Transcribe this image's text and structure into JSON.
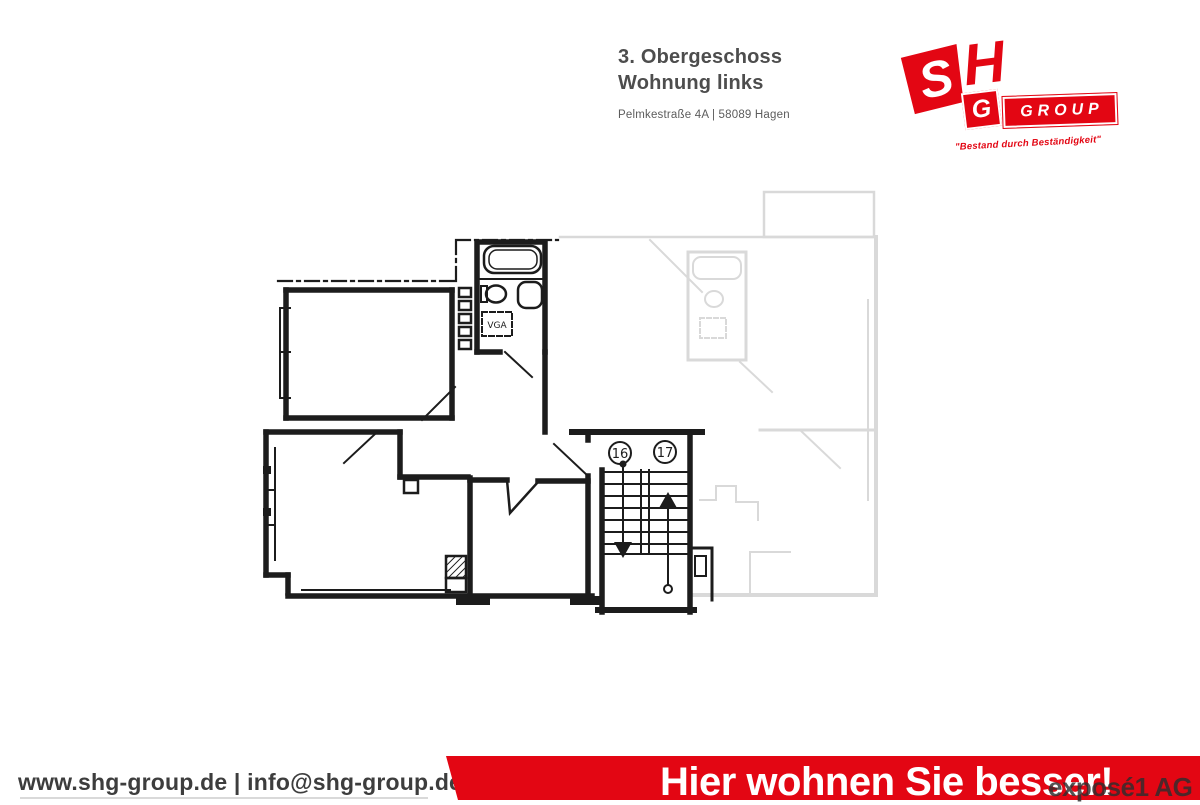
{
  "page": {
    "background": "#ffffff"
  },
  "header": {
    "title_line1": "3. Obergeschoss",
    "title_line2": "Wohnung links",
    "address": "Pelmkestraße 4A | 58089 Hagen"
  },
  "logo": {
    "letter_s": "S",
    "letter_h": "H",
    "letter_g": "G",
    "group_word": "GROUP",
    "tagline": "\"Bestand durch Beständigkeit\"",
    "brand_color": "#e30613"
  },
  "floorplan": {
    "stair_number_left": "16",
    "stair_number_right": "17",
    "duct_label": "VGA",
    "ink_color": "#1c1c1c",
    "faded_color": "#d9d9d9"
  },
  "footer": {
    "contact": "www.shg-group.de | info@shg-group.de",
    "slogan": "Hier wohnen Sie besser!",
    "watermark": "exposé1 AG",
    "bar_color": "#e30613"
  }
}
